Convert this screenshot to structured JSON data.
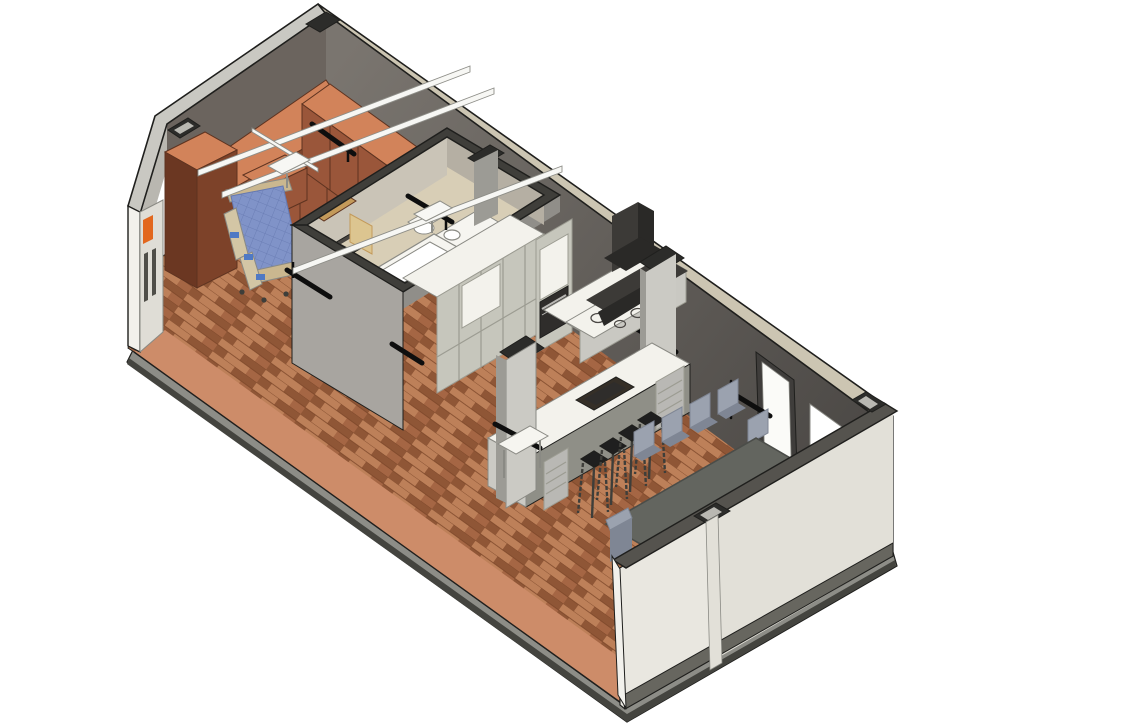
{
  "scene": {
    "view": "isometric-section-cutaway-3d-model",
    "rooms": [
      "bedroom",
      "bathroom",
      "kitchen",
      "dining-area"
    ],
    "objects": [
      "hospital-bed",
      "wardrobes",
      "ceiling-lift-tracks",
      "bathtub",
      "lavatory-counter",
      "wall-hung-toilet",
      "shower-drain",
      "bathroom-door",
      "kitchen-cabinets",
      "wall-oven",
      "range-hood",
      "cooktop",
      "bar-counter",
      "bar-sink",
      "bar-stools",
      "dining-table",
      "dining-chairs",
      "entry-door",
      "pass-through-window",
      "grab-bars",
      "structural-columns",
      "wood-floor"
    ]
  },
  "palette": {
    "outline": "#1f1f1d",
    "plank_light": "#bd8059",
    "plank_mid": "#a56644",
    "plank_dark": "#8f5636",
    "plank_seam": "#7a4527",
    "floor_cut_band": "#cd8c69",
    "slab_face": "#8d8d87",
    "slab_dark": "#44443f",
    "wall_top_light": "#c9c8c2",
    "wall_top_tan": "#ccc5b2",
    "wall_top_dark": "#55534e",
    "wall_int_dark1": "#7a756f",
    "wall_int_dark2": "#4a4744",
    "wall_int_nw": "#6b645e",
    "chamfer_face": "#b9b7b0",
    "panel_face": "#dfddd6",
    "panel_slot": "#4f4e49",
    "accent_orange": "#e2671e",
    "wall_end_white": "#f2f1ec",
    "bath_ext_sw": "#a8a5a0",
    "bath_ext_se": "#908e89",
    "bath_top": "#3f3e3a",
    "bath_inner_a": "#cac4b7",
    "bath_inner_b": "#b5afa3",
    "bath_floor": "#d8ceb6",
    "fixture_white": "#f6f5f0",
    "fixture_line": "#8a8a84",
    "door_tan_frame": "#c39a5a",
    "door_tan_leaf": "#dcc590",
    "shower_dark": "#474440",
    "wardrobe_top": "#d2835a",
    "wardrobe_front": "#9a563a",
    "wardrobe_side": "#7d4229",
    "wardrobe_dark": "#6b3722",
    "wardrobe_line": "#5e3320",
    "bed_mattress": "#8093c8",
    "bed_grid": "#6679b0",
    "bed_frame": "#cab78f",
    "bed_rail": "#d3c6a5",
    "bed_screen": "#4f79c4",
    "cab_front": "#c6c6bc",
    "cab_frame": "#9c9c92",
    "cab_side": "#8f8f87",
    "counter_white": "#f3f2ec",
    "counter_face": "#c9c8c2",
    "oven_dark": "#2f2d2b",
    "steel": "#b9b8b4",
    "hood_dark": "#3c3a37",
    "hood_darker": "#2a2927",
    "col_light": "#cbcac4",
    "col_mid": "#9c9b95",
    "cap_dark": "#2c2c2a",
    "cap_inner": "#b9b8b2",
    "stool_black": "#1f1f1f",
    "stool_leg": "#3e3e3a",
    "table_top": "#63655f",
    "table_edge": "#4b4d49",
    "chair_light": "#9ba2af",
    "chair_dark": "#7f8694",
    "ext_cream": "#e9e7e0",
    "ext_cream2": "#e2e0d8",
    "base_trim": "#67665f",
    "track_white": "#f7f7f4",
    "track_line": "#8e8e88",
    "door_frame_dark": "#3f3d3b",
    "door_leaf": "#fbfbf8",
    "sink_dark": "#352f27",
    "grab_black": "#0e0e0e",
    "white": "#ffffff"
  }
}
